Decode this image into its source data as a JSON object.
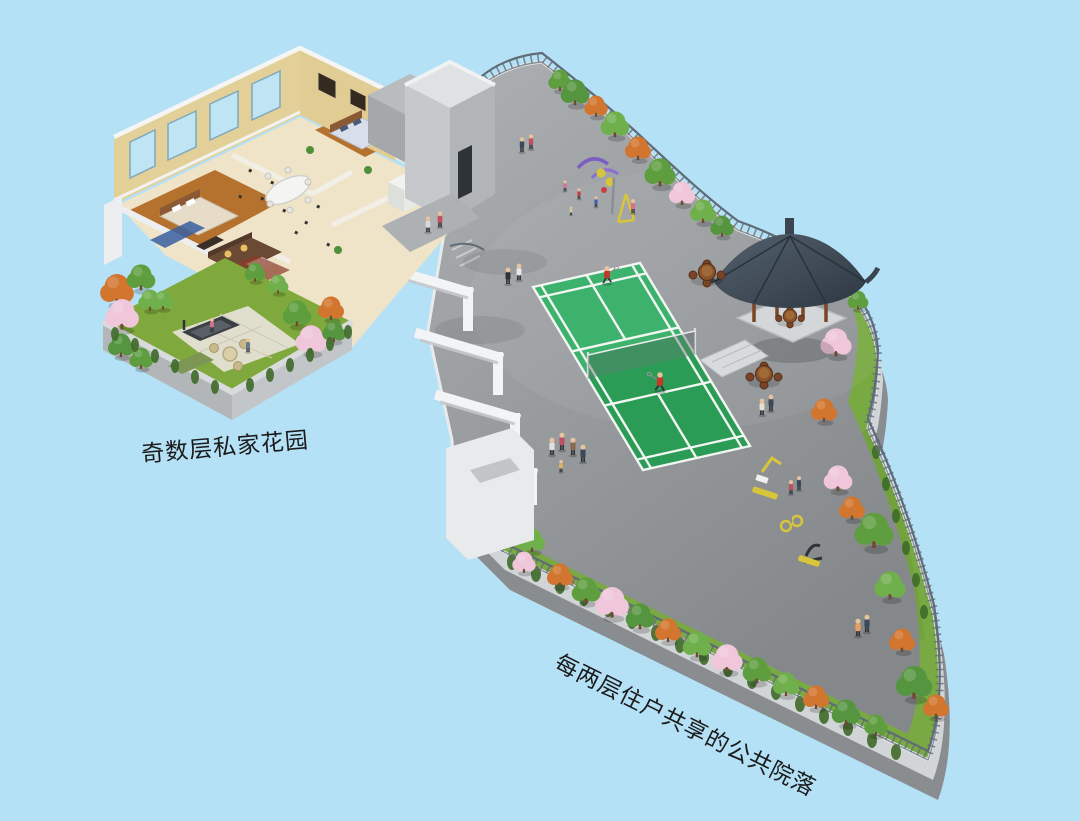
{
  "scene": {
    "type": "3d-architectural-rendering",
    "background_color": "#B5E1F6",
    "labels": {
      "private_garden": "奇数层私家花园",
      "shared_courtyard": "每两层住户共享的公共院落"
    },
    "colors": {
      "terrace_concrete": "#94979A",
      "terrace_curb": "#E8EAEC",
      "court_green_light": "#3DB26C",
      "court_green_dark": "#2B9C55",
      "court_lines": "#F2F6F3",
      "grass_band": "#79A943",
      "pavilion_roof": "#414C58",
      "wood_furniture": "#7A4526",
      "apartment_wall": "#E9D9A6",
      "window_glass": "#BFE4F4",
      "railing": "#5F6B76",
      "tree_green": "#5E9E3E",
      "tree_pink": "#EFC6DA",
      "tree_orange": "#D2752E",
      "label_text": "#1B1B1B"
    },
    "elements": [
      "furnished apartment interior cutaway",
      "private roof garden with treadmill and rattan seating",
      "shared courtyard terrace",
      "badminton court with two players",
      "chinese pavilion with wooden table sets",
      "children playground equipment",
      "outdoor fitness equipment",
      "perimeter railing with planting band",
      "stair core block",
      "residents walking on terrace"
    ]
  }
}
